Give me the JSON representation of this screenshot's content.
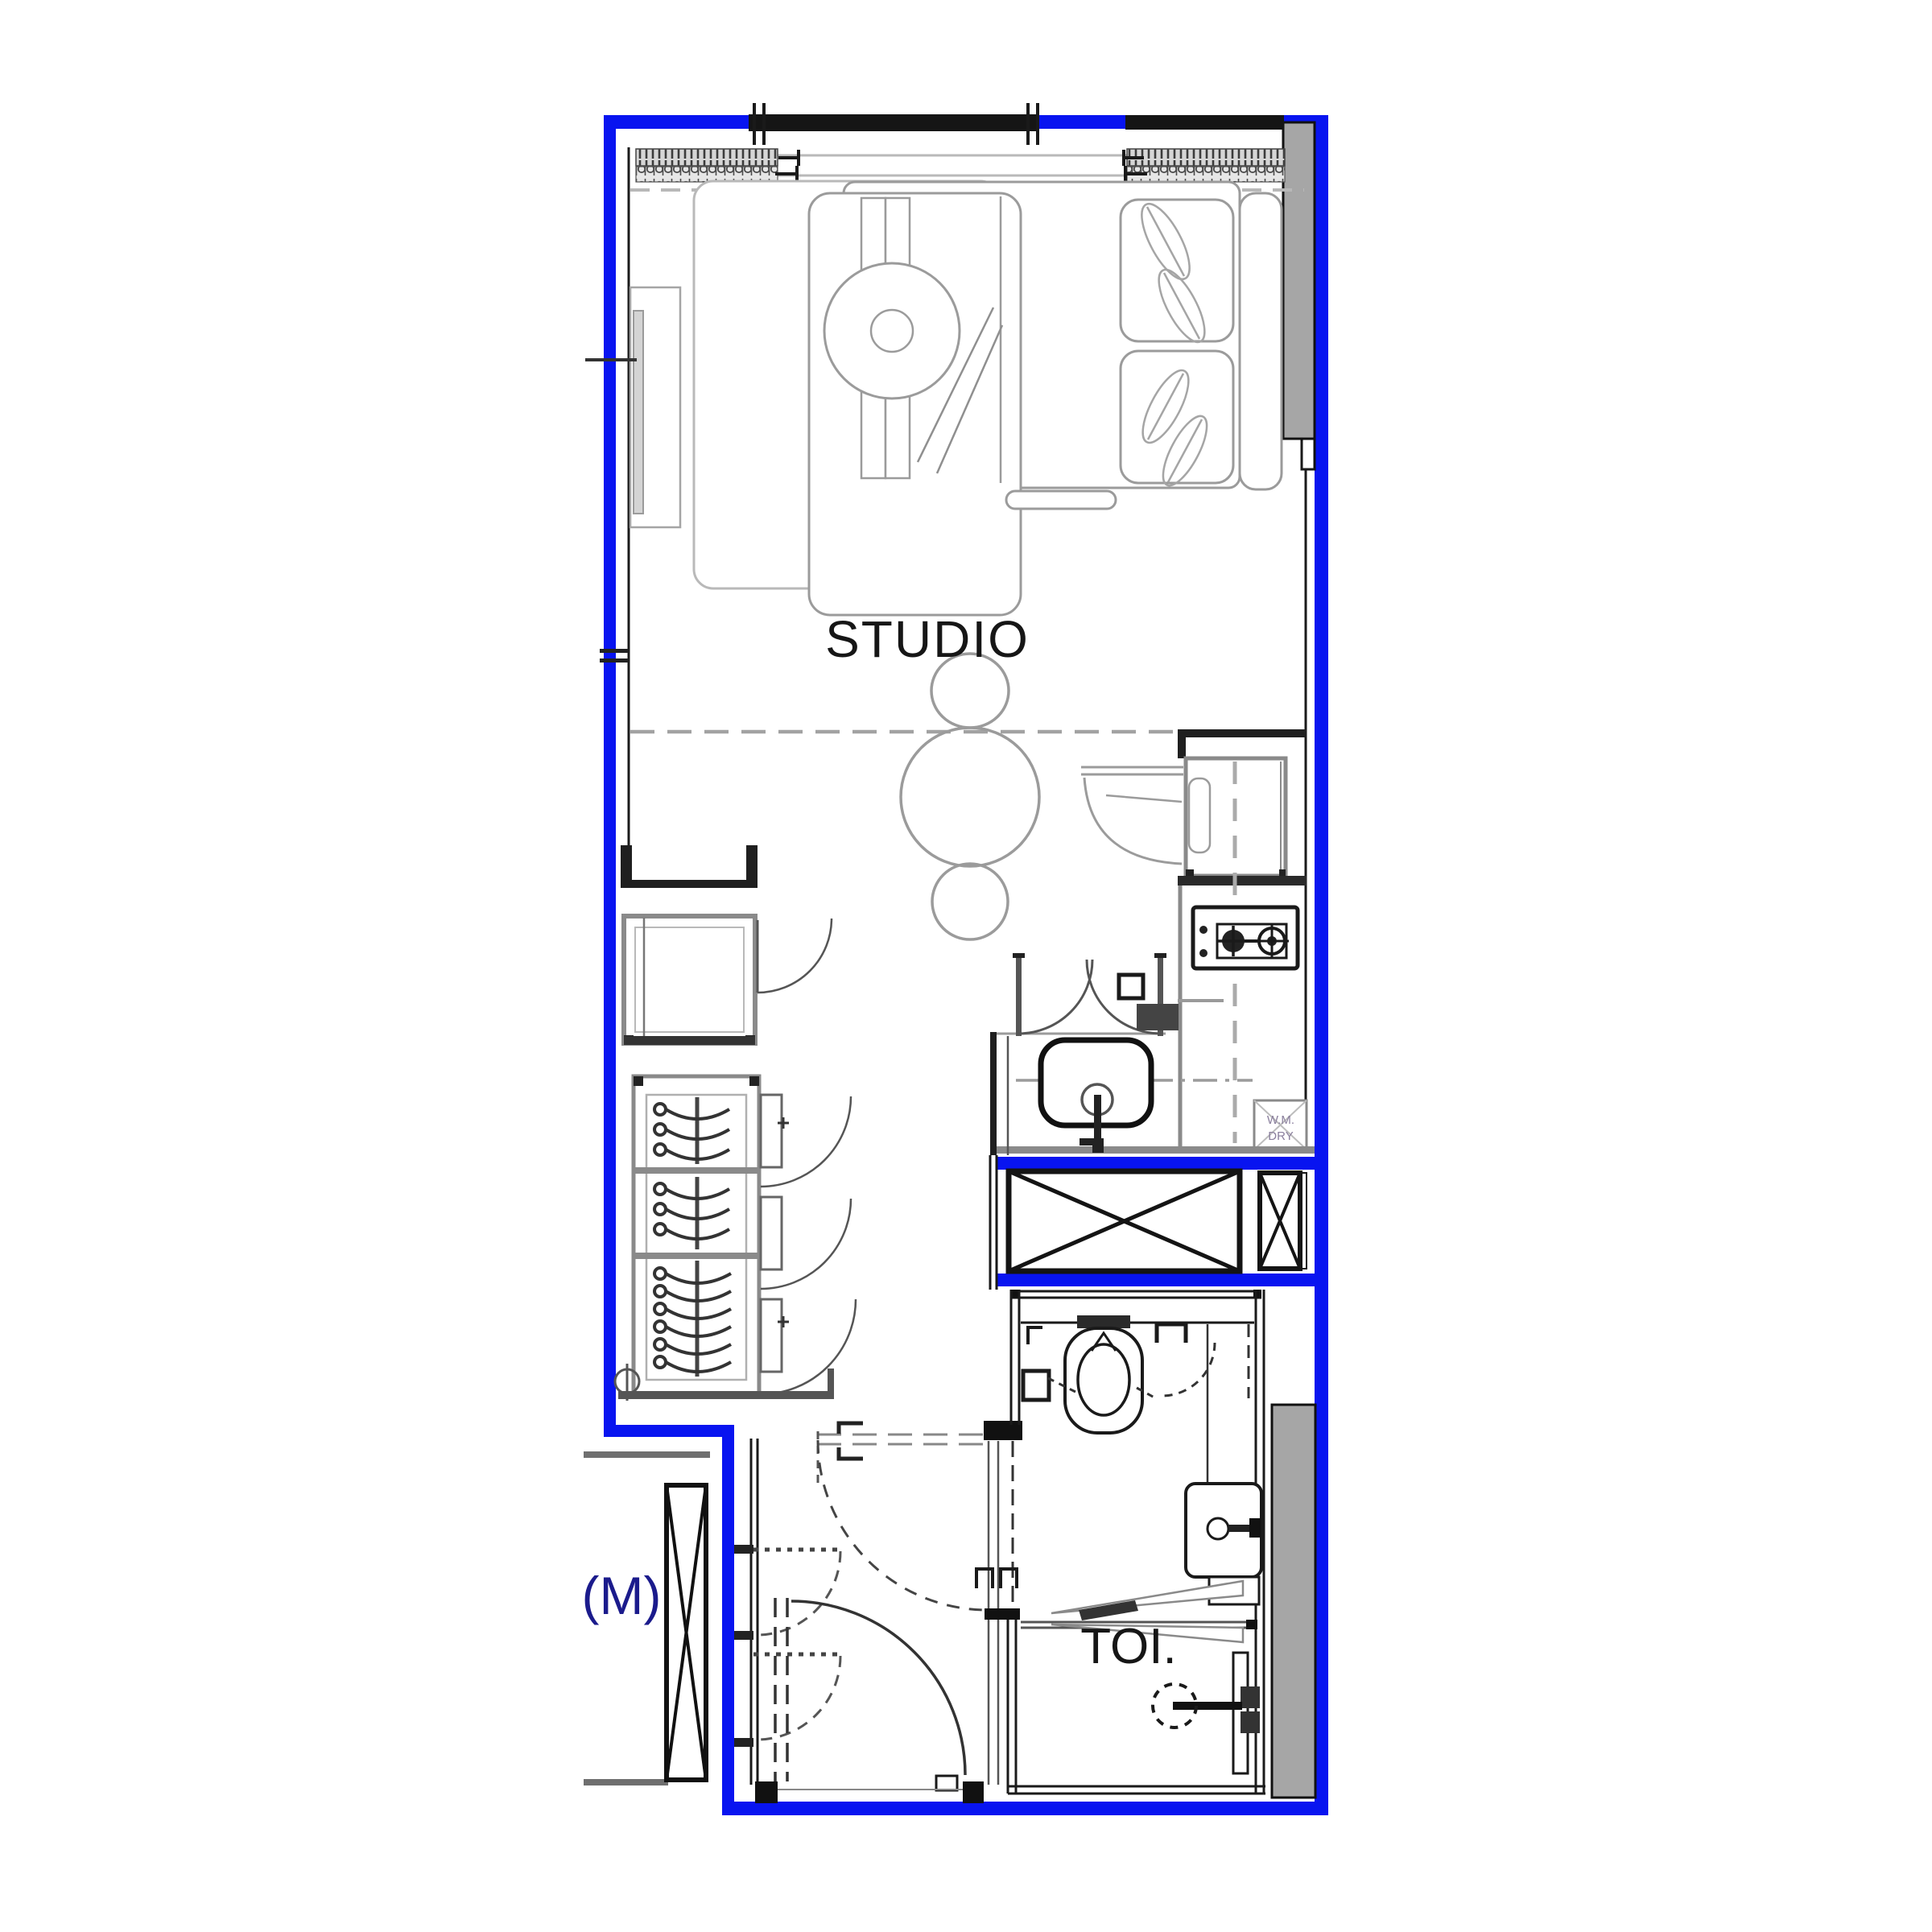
{
  "title": "Studio unit floor plan",
  "labels": {
    "studio": "STUDIO",
    "toilet": "TOI.",
    "adjacent_unit": "(M)",
    "washer_dryer_line1": "W.M.",
    "washer_dryer_line2": "DRY"
  },
  "colors": {
    "unit_outline_blue": "#0814f0",
    "wall_dark": "#1a1a1a",
    "structural_gray": "#a6a6a6",
    "furniture_gray": "#9b9b9b",
    "label_blue": "#1b1b8c"
  },
  "icons": {
    "service_shaft": "x-brace-box",
    "structural_column": "x-brace-column",
    "stove": "two-burner-hob",
    "wardrobe": "hanger-rail"
  }
}
